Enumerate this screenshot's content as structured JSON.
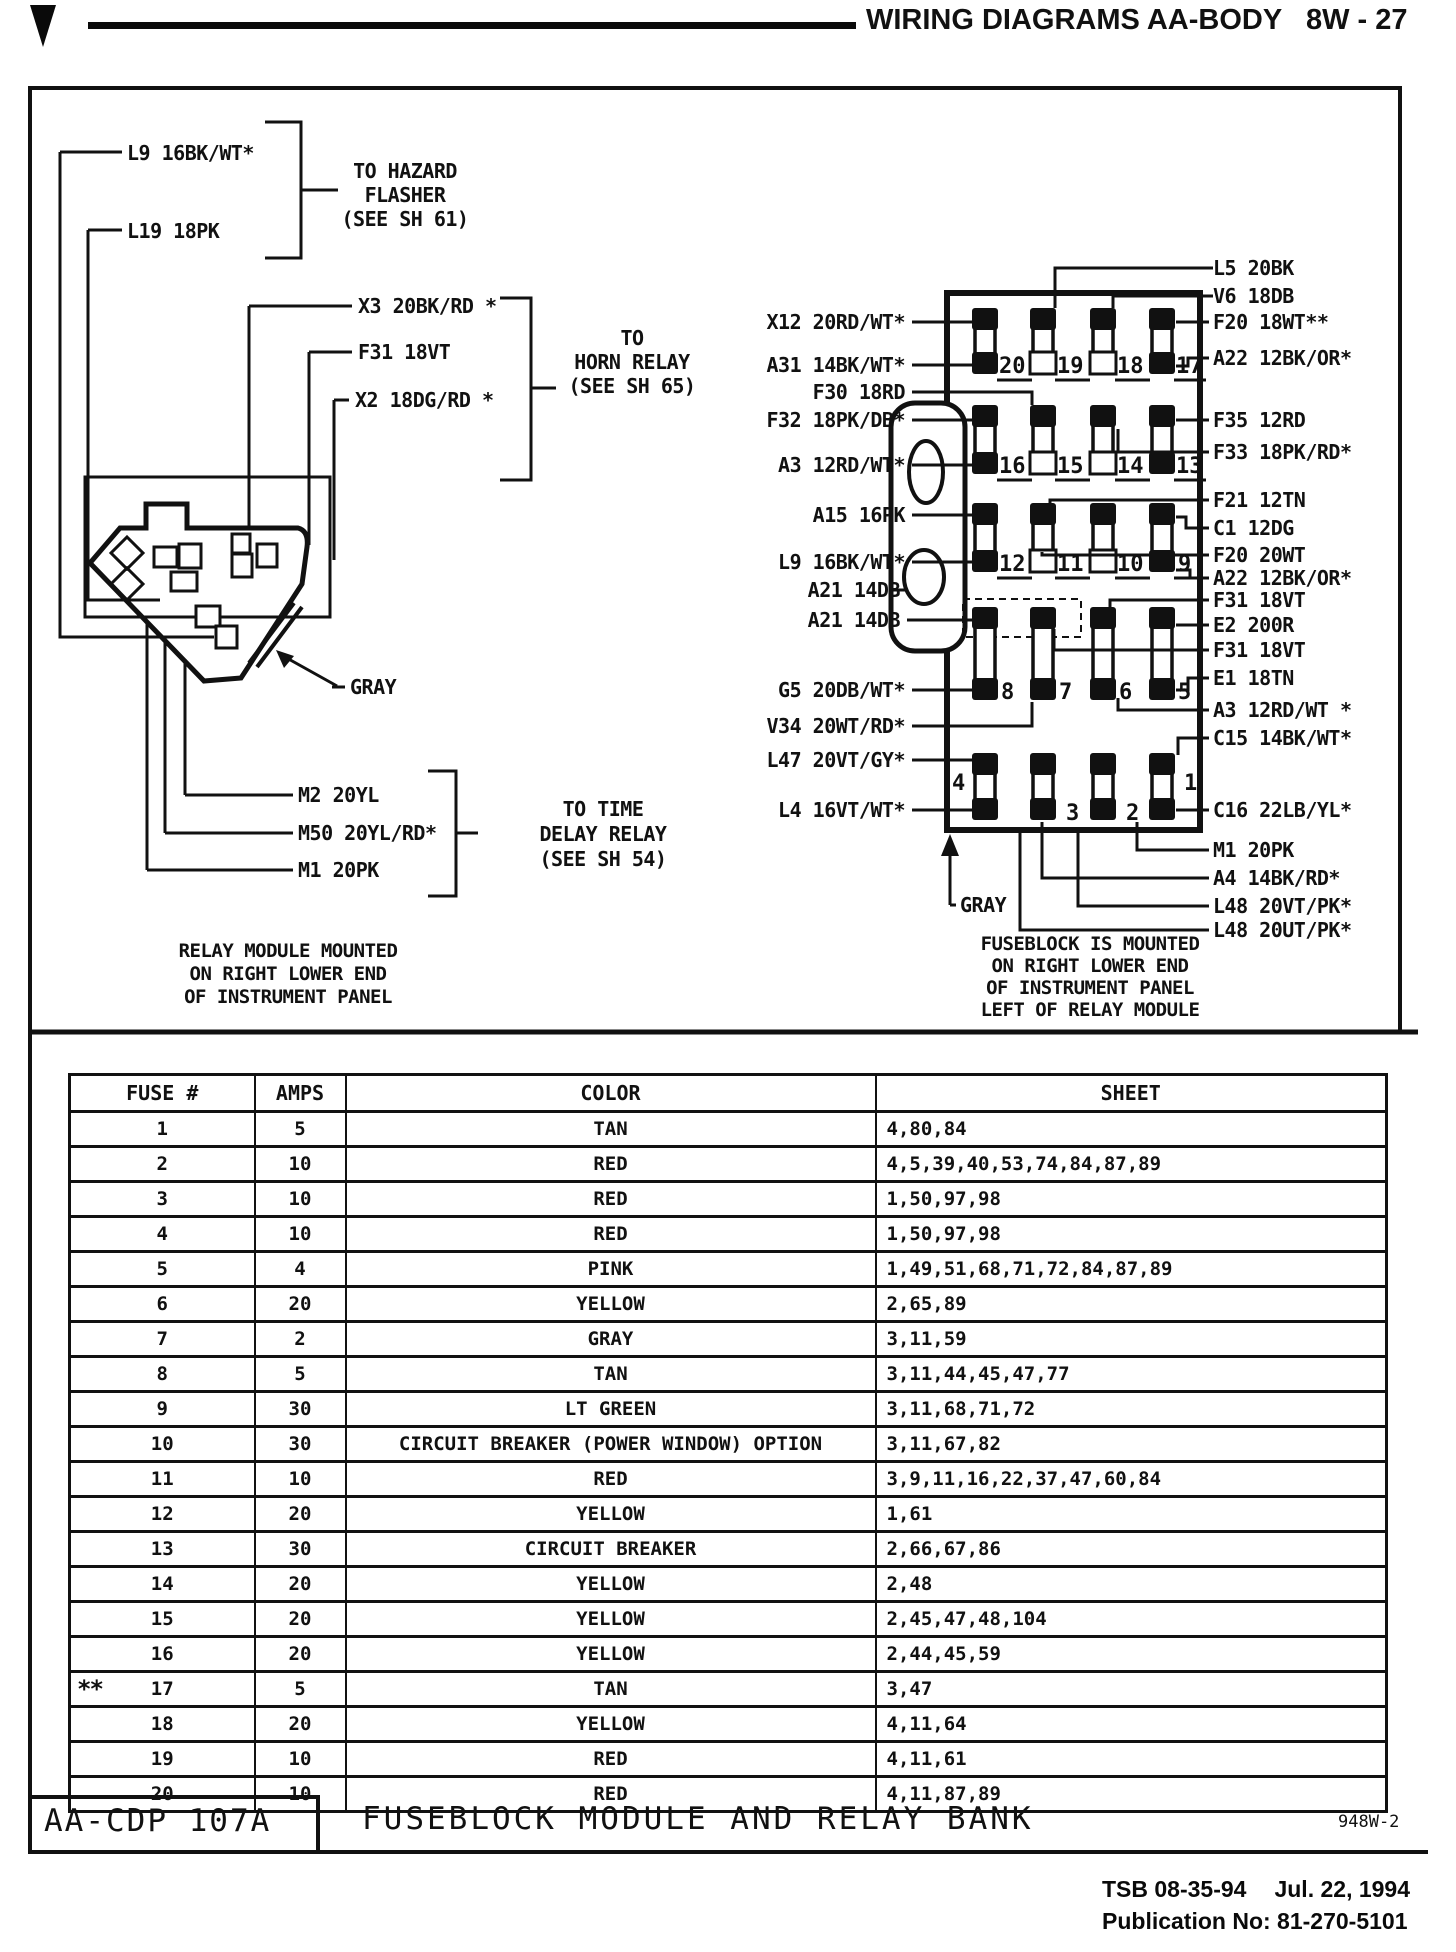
{
  "header": {
    "title": "WIRING DIAGRAMS AA-BODY",
    "page": "8W - 27"
  },
  "relay_module": {
    "wires_top": [
      "L9 16BK/WT*",
      "L19 18PK"
    ],
    "callout_hazard": [
      "TO HAZARD",
      "FLASHER",
      "(SEE SH 61)"
    ],
    "wires_mid": [
      "X3 20BK/RD *",
      "F31 18VT",
      "X2 18DG/RD *"
    ],
    "callout_horn": [
      "TO",
      "HORN RELAY",
      "(SEE SH 65)"
    ],
    "wires_bottom": [
      "M2 20YL",
      "M50 20YL/RD*",
      "M1 20PK"
    ],
    "callout_time_delay": [
      "TO TIME",
      "DELAY RELAY",
      "(SEE SH 54)"
    ],
    "gray_label": "GRAY",
    "caption": [
      "RELAY MODULE MOUNTED",
      "ON RIGHT LOWER END",
      "OF INSTRUMENT PANEL"
    ]
  },
  "fuseblock": {
    "left_labels": [
      "X12 20RD/WT*",
      "A31 14BK/WT*",
      "F30 18RD",
      "F32 18PK/DB*",
      "A3 12RD/WT*",
      "A15 16PK",
      "L9 16BK/WT*",
      "A21 14DB",
      "A21 14DB",
      "G5 20DB/WT*",
      "V34 20WT/RD*",
      "L47 20VT/GY*",
      "L4 16VT/WT*"
    ],
    "right_labels": [
      "L5 20BK",
      "V6 18DB",
      "F20 18WT**",
      "A22 12BK/OR*",
      "F35 12RD",
      "F33 18PK/RD*",
      "F21 12TN",
      "C1 12DG",
      "F20 20WT",
      "A22 12BK/OR*",
      "F31 18VT",
      "E2 200R",
      "F31 18VT",
      "E1 18TN",
      "A3 12RD/WT *",
      "C15 14BK/WT*",
      "C16 22LB/YL*",
      "M1 20PK",
      "A4 14BK/RD*",
      "L48 20VT/PK*",
      "L48 20UT/PK*"
    ],
    "fuse_numbers": [
      "20",
      "19",
      "18",
      "17",
      "16",
      "15",
      "14",
      "13",
      "12",
      "11",
      "10",
      "9",
      "8",
      "7",
      "6",
      "5",
      "4",
      "3",
      "2",
      "1"
    ],
    "gray_label": "GRAY",
    "caption": [
      "FUSEBLOCK IS MOUNTED",
      "ON RIGHT LOWER END",
      "OF INSTRUMENT PANEL",
      "LEFT OF RELAY MODULE"
    ]
  },
  "fuse_table": {
    "headers": [
      "FUSE #",
      "AMPS",
      "COLOR",
      "SHEET"
    ],
    "rows": [
      {
        "fuse": "1",
        "amps": "5",
        "color": "TAN",
        "sheet": "4,80,84"
      },
      {
        "fuse": "2",
        "amps": "10",
        "color": "RED",
        "sheet": "4,5,39,40,53,74,84,87,89"
      },
      {
        "fuse": "3",
        "amps": "10",
        "color": "RED",
        "sheet": "1,50,97,98"
      },
      {
        "fuse": "4",
        "amps": "10",
        "color": "RED",
        "sheet": "1,50,97,98"
      },
      {
        "fuse": "5",
        "amps": "4",
        "color": "PINK",
        "sheet": "1,49,51,68,71,72,84,87,89"
      },
      {
        "fuse": "6",
        "amps": "20",
        "color": "YELLOW",
        "sheet": "2,65,89"
      },
      {
        "fuse": "7",
        "amps": "2",
        "color": "GRAY",
        "sheet": "3,11,59"
      },
      {
        "fuse": "8",
        "amps": "5",
        "color": "TAN",
        "sheet": "3,11,44,45,47,77"
      },
      {
        "fuse": "9",
        "amps": "30",
        "color": "LT GREEN",
        "sheet": "3,11,68,71,72"
      },
      {
        "fuse": "10",
        "amps": "30",
        "color": "CIRCUIT BREAKER (POWER WINDOW) OPTION",
        "sheet": "3,11,67,82"
      },
      {
        "fuse": "11",
        "amps": "10",
        "color": "RED",
        "sheet": "3,9,11,16,22,37,47,60,84"
      },
      {
        "fuse": "12",
        "amps": "20",
        "color": "YELLOW",
        "sheet": "1,61"
      },
      {
        "fuse": "13",
        "amps": "30",
        "color": "CIRCUIT BREAKER",
        "sheet": "2,66,67,86"
      },
      {
        "fuse": "14",
        "amps": "20",
        "color": "YELLOW",
        "sheet": "2,48"
      },
      {
        "fuse": "15",
        "amps": "20",
        "color": "YELLOW",
        "sheet": "2,45,47,48,104"
      },
      {
        "fuse": "16",
        "amps": "20",
        "color": "YELLOW",
        "sheet": "2,44,45,59"
      },
      {
        "fuse": "17",
        "amps": "5",
        "color": "TAN",
        "sheet": "3,47",
        "marker": "**"
      },
      {
        "fuse": "18",
        "amps": "20",
        "color": "YELLOW",
        "sheet": "4,11,64"
      },
      {
        "fuse": "19",
        "amps": "10",
        "color": "RED",
        "sheet": "4,11,61"
      },
      {
        "fuse": "20",
        "amps": "10",
        "color": "RED",
        "sheet": "4,11,87,89"
      }
    ]
  },
  "title_block": {
    "code": "AA-CDP 107A",
    "title": "FUSEBLOCK MODULE AND RELAY BANK",
    "drawing_no": "948W-2"
  },
  "footer": {
    "tsb": "TSB 08-35-94",
    "date": "Jul. 22, 1994",
    "publication": "Publication No: 81-270-5101"
  }
}
